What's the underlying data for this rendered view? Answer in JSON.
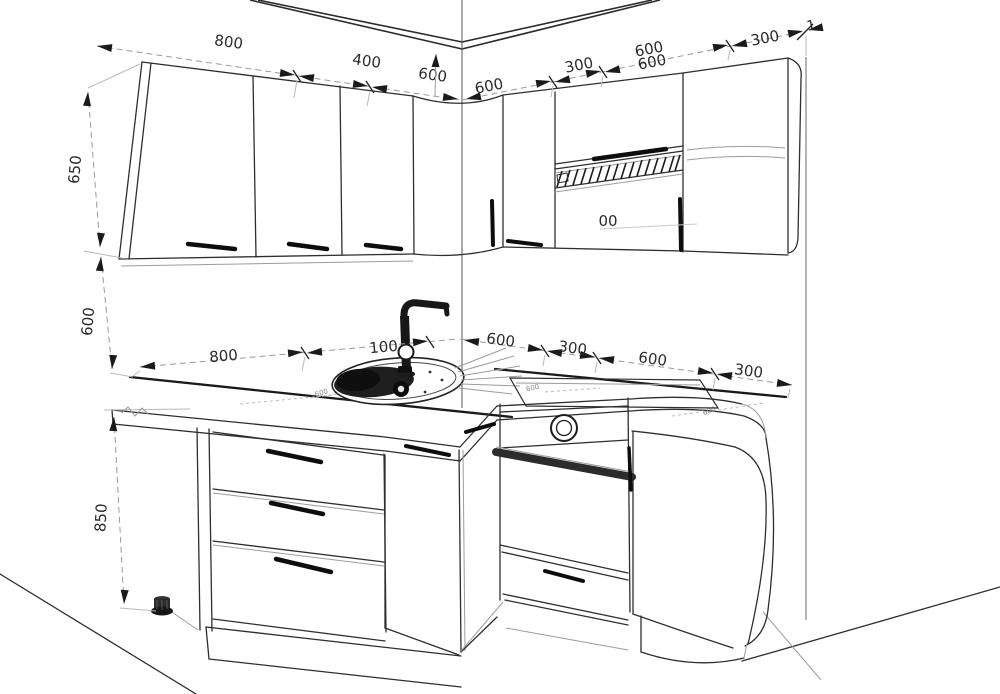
{
  "drawing": {
    "type": "corner-kitchen-elevation",
    "colors": {
      "background": "#ffffff",
      "cabinet_line": "#2e2e2e",
      "heavy_line": "#1a1a1a",
      "dimension_line": "#9a9a9a",
      "text": "#2a2a2a"
    },
    "dims": {
      "wall_top_left": [
        "800",
        "400",
        "600"
      ],
      "wall_top_right": [
        "600",
        "300",
        "600",
        "600",
        "300",
        "1"
      ],
      "left_heights": [
        "650",
        "600",
        "850"
      ],
      "counter_left": [
        "800",
        "100"
      ],
      "counter_right": [
        "600",
        "300",
        "600",
        "300"
      ],
      "hood_partial_label": "00",
      "counter_depth_marks": [
        "600",
        "600",
        "600"
      ]
    }
  }
}
